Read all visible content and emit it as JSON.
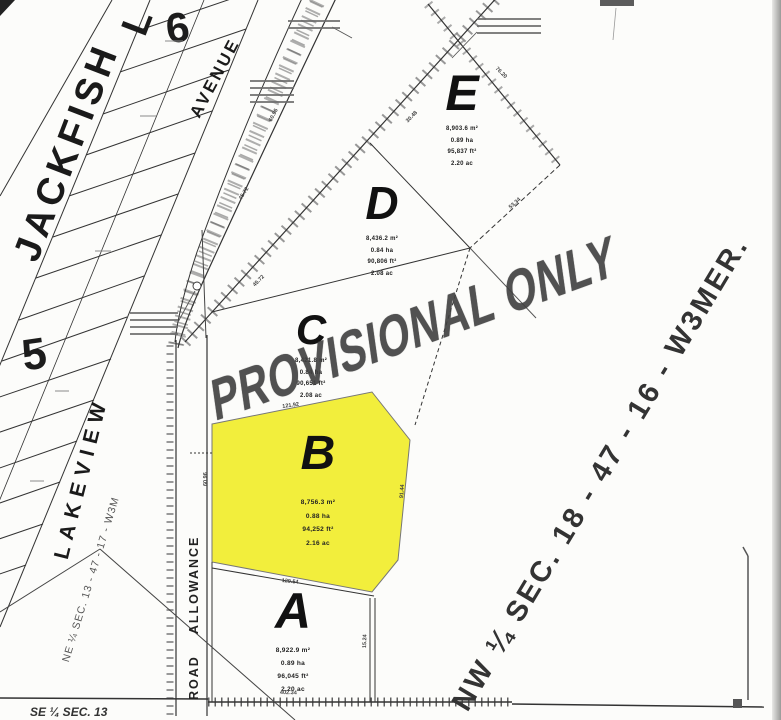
{
  "watermark": "PROVISIONAL ONLY",
  "streets": {
    "jackfish": "JACKFISH",
    "jackfish_overflow": "L",
    "avenue": "AVENUE",
    "lakeview": "LAKEVIEW",
    "road_allowance": "ROAD ALLOWANCE"
  },
  "sections": {
    "nw_quarter": "NW ¼ SEC. 18 - 47 - 16 - W3MER.",
    "ne_quarter": "NE ¼ SEC. 13 - 47 - 17 - W3M",
    "se_quarter": "SE ¼ SEC. 13"
  },
  "blocks": {
    "six": "6",
    "five": "5"
  },
  "lots": {
    "e": {
      "label": "E",
      "area_lines": [
        "8,903.6 m²",
        "0.89 ha",
        "95,837 ft²",
        "2.20 ac"
      ]
    },
    "d": {
      "label": "D",
      "area_lines": [
        "8,436.2 m²",
        "0.84 ha",
        "90,806 ft²",
        "2.08 ac"
      ]
    },
    "c": {
      "label": "C",
      "area_lines": [
        "8,421.8 m²",
        "0.84 ha",
        "90,651 ft²",
        "2.08 ac"
      ]
    },
    "b": {
      "label": "B",
      "highlighted": true,
      "area_lines": [
        "8,756.3 m²",
        "0.88 ha",
        "94,252 ft²",
        "2.16 ac"
      ]
    },
    "a": {
      "label": "A",
      "area_lines": [
        "8,922.9 m²",
        "0.89 ha",
        "96,045 ft²",
        "2.20 ac"
      ]
    }
  },
  "dimensions": [
    "121.92",
    "60.96",
    "129.54",
    "91.44",
    "45.72",
    "30.48",
    "402.34",
    "15.24",
    "76.20",
    "53.34"
  ],
  "colors": {
    "highlight": "#f2ee3c",
    "ink": "#1c1c1c",
    "watermark": "#3f3f3f"
  }
}
